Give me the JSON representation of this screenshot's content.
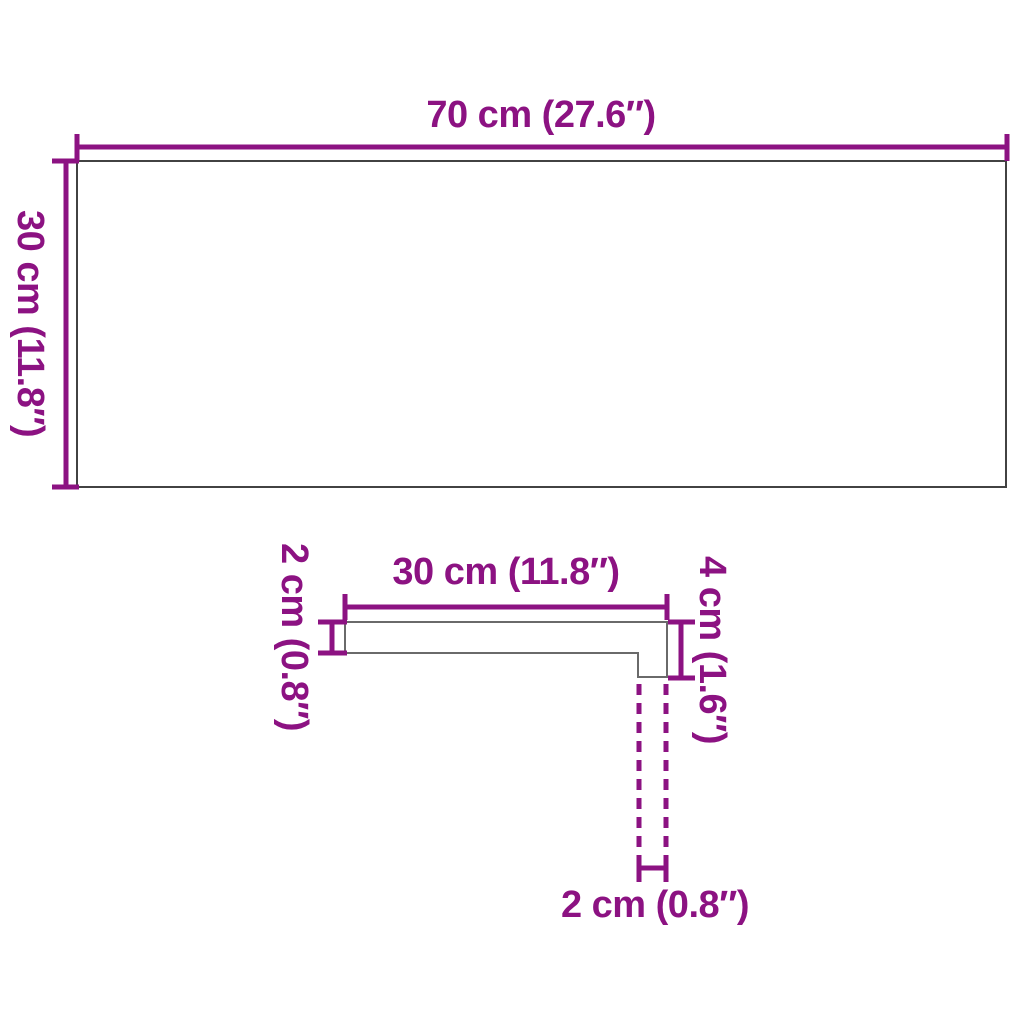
{
  "colors": {
    "accent": "#8C1282",
    "outline_dark": "#424242",
    "outline_light": "#6a6a6a",
    "background": "#ffffff"
  },
  "top_view": {
    "width_label": "70 cm (27.6″)",
    "height_label": "30 cm (11.8″)"
  },
  "side_view": {
    "depth_label": "30 cm (11.8″)",
    "thickness_label": "2 cm (0.8″)",
    "nose_height_label": "4 cm (1.6″)",
    "nose_width_label": "2 cm (0.8″)"
  }
}
